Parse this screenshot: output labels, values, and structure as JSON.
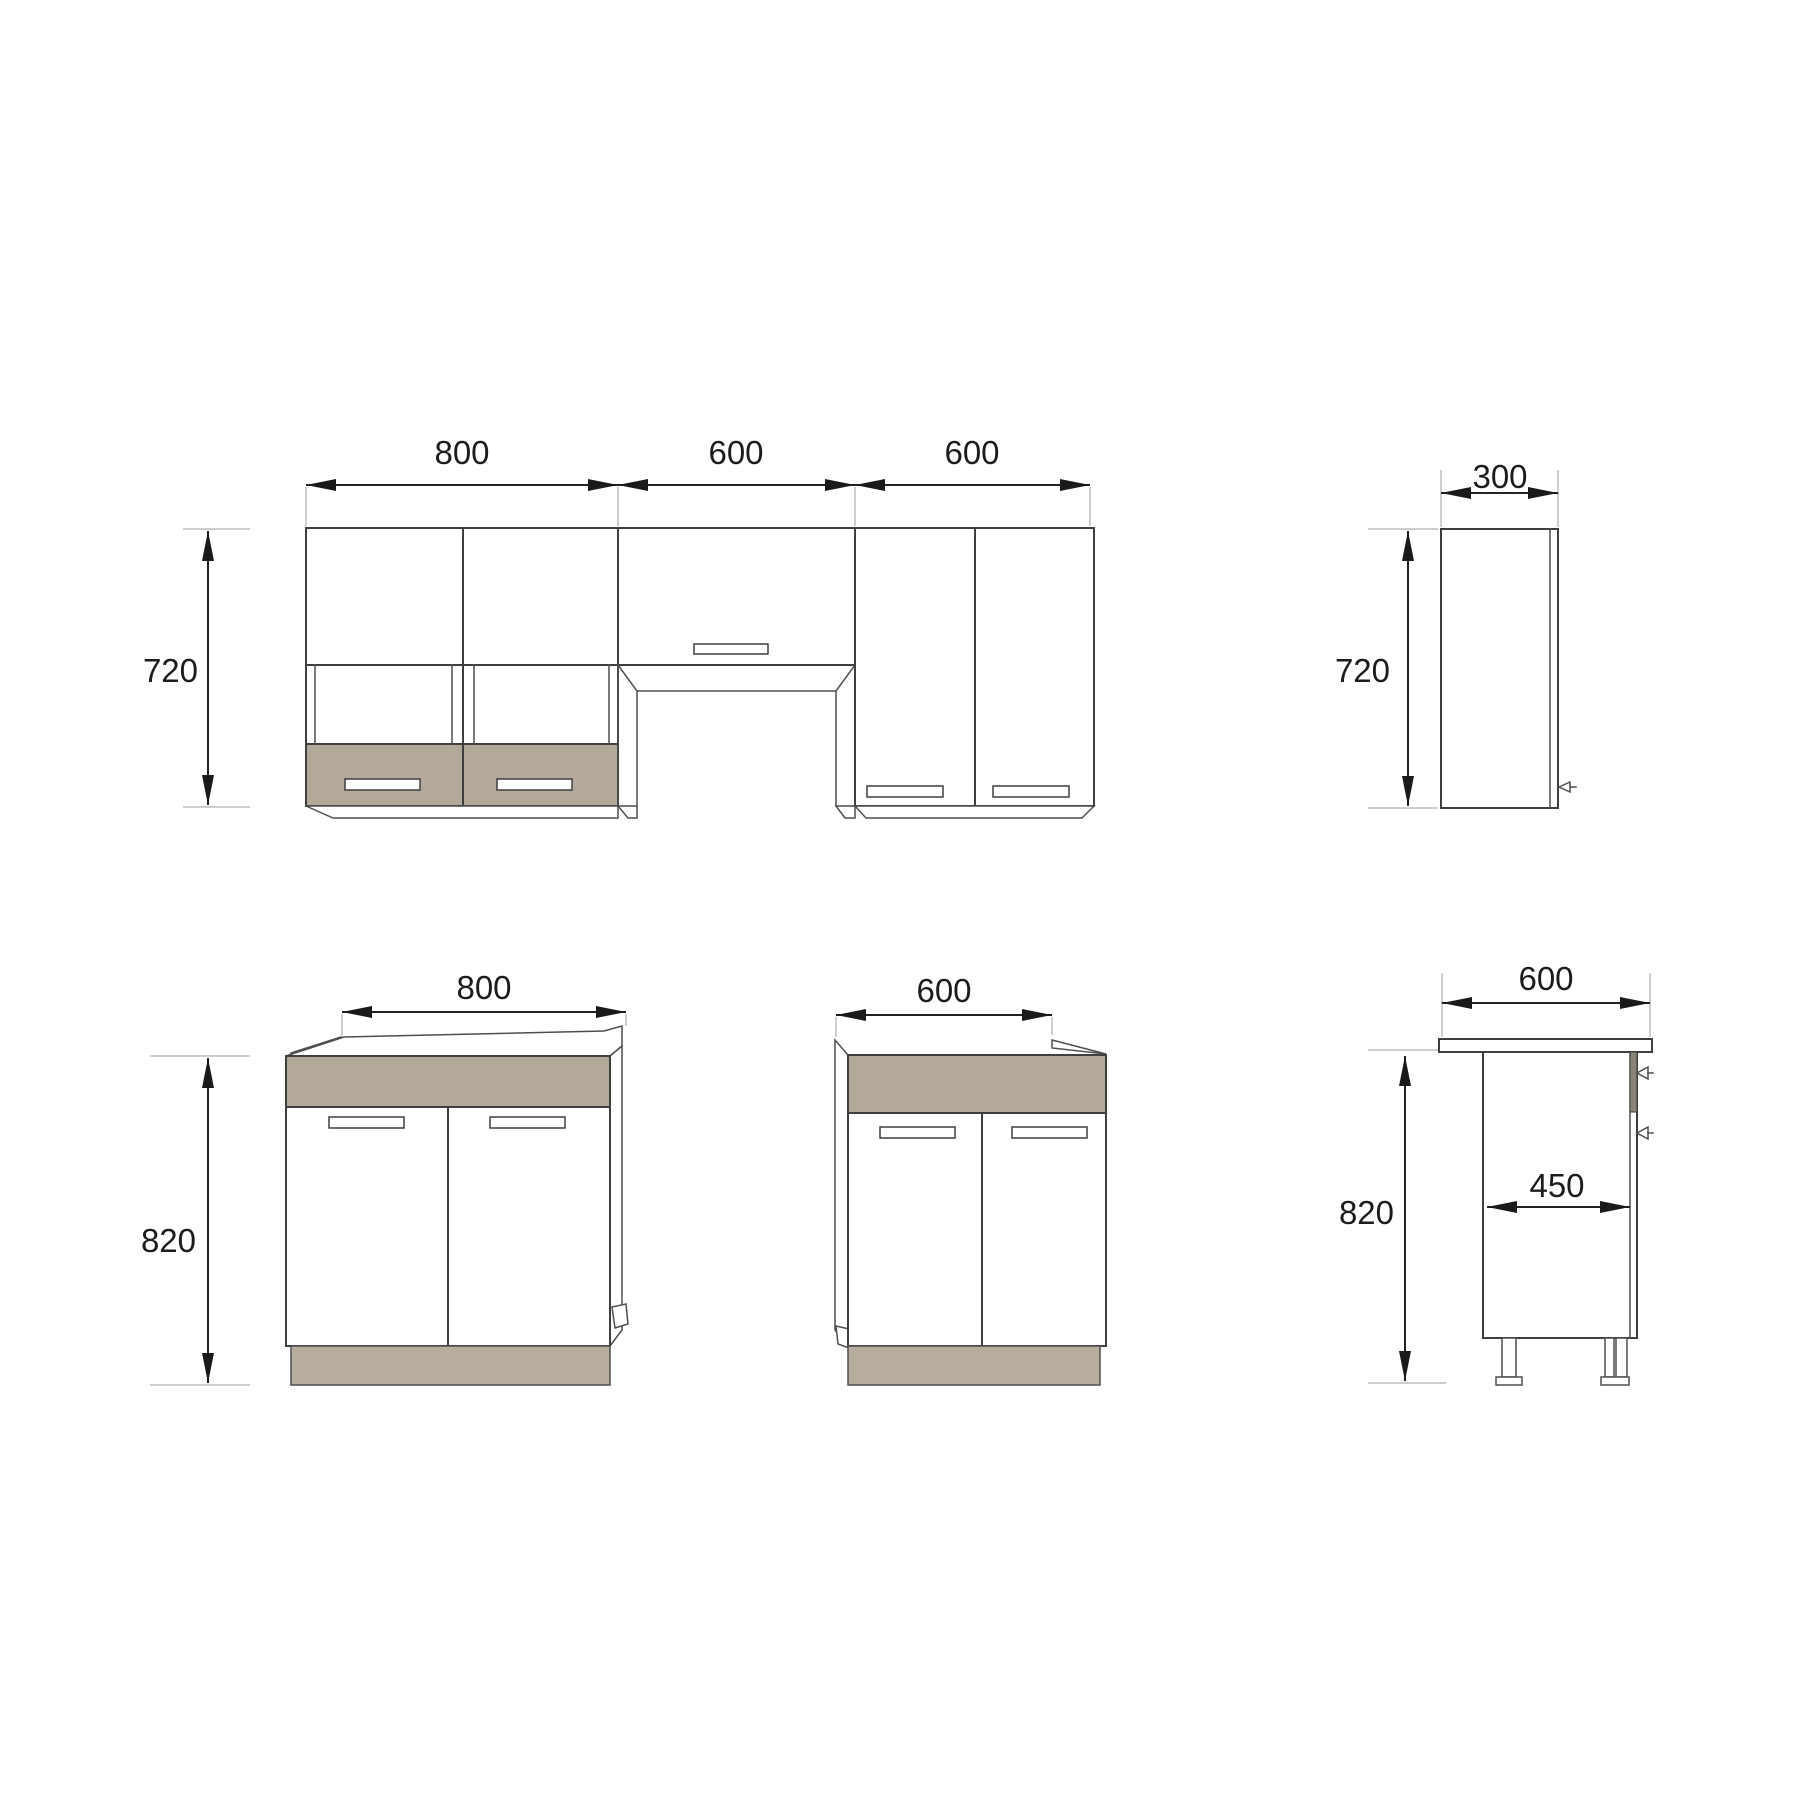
{
  "colors": {
    "front_panel": "#b2a99b",
    "plinth": "#b6ad9f",
    "mount_rail": "#8a8478"
  },
  "views": {
    "wall_front": {
      "width_1": "800",
      "width_2": "600",
      "width_3": "600",
      "height": "720"
    },
    "wall_side": {
      "depth": "300",
      "height": "720"
    },
    "base_800_front": {
      "width": "800",
      "height": "820"
    },
    "base_600_front": {
      "width": "600"
    },
    "base_side": {
      "depth": "600",
      "height": "820",
      "inner_depth": "450"
    }
  }
}
